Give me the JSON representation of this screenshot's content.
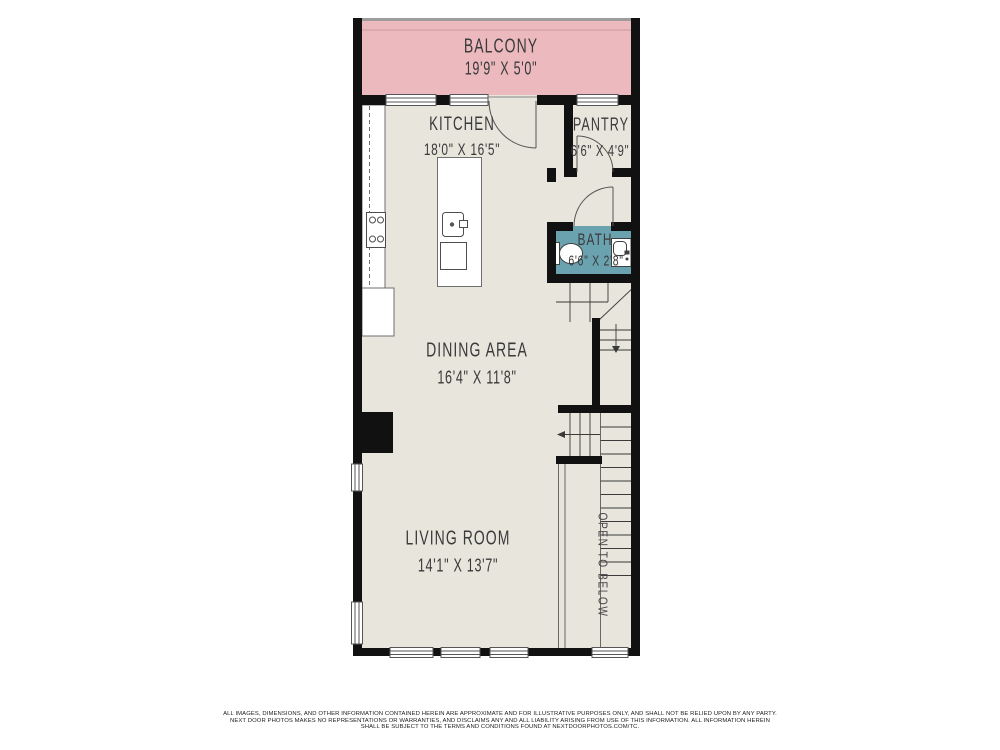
{
  "rooms": {
    "balcony": {
      "name": "BALCONY",
      "dims": "19'9\" X 5'0\""
    },
    "kitchen": {
      "name": "KITCHEN",
      "dims": "18'0\" X 16'5\""
    },
    "pantry": {
      "name": "PANTRY",
      "dims": "6'6\" X 4'9\""
    },
    "bath": {
      "name": "BATH",
      "dims": "6'6\" X 2'8\""
    },
    "dining": {
      "name": "DINING AREA",
      "dims": "16'4\" X 11'8\""
    },
    "living": {
      "name": "LIVING ROOM",
      "dims": "14'1\" X 13'7\""
    }
  },
  "annotations": {
    "stairwell": "OPEN TO BELOW"
  },
  "colors": {
    "wall": "#111111",
    "floor": "#e7e5dc",
    "balcony_fill": "#ecb9be",
    "bath_fill": "#6aa2b0"
  },
  "footer": {
    "line1": "ALL IMAGES, DIMENSIONS, AND OTHER INFORMATION CONTAINED HEREIN ARE APPROXIMATE AND FOR ILLUSTRATIVE PURPOSES ONLY, AND SHALL NOT BE RELIED UPON BY ANY PARTY.",
    "line2": "NEXT DOOR PHOTOS MAKES NO REPRESENTATIONS OR WARRANTIES, AND DISCLAIMS ANY AND ALL LIABILITY ARISING FROM USE OF THIS INFORMATION. ALL INFORMATION HEREIN",
    "line3": "SHALL BE SUBJECT TO THE TERMS AND CONDITIONS FOUND AT NEXTDOORPHOTOS.COM/TC."
  }
}
